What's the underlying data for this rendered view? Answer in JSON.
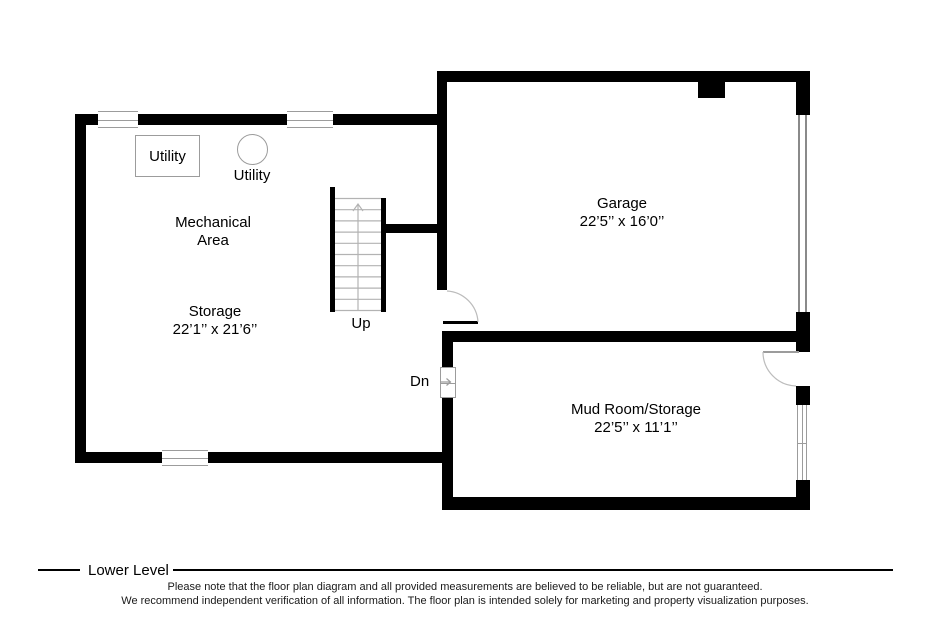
{
  "floor_label": "Lower Level",
  "rooms": {
    "storage": {
      "area_line1": "Mechanical",
      "area_line2": "Area",
      "name": "Storage",
      "dims": "22’1’’ x 21’6’’"
    },
    "garage": {
      "name": "Garage",
      "dims": "22’5’’ x 16’0’’"
    },
    "mudroom": {
      "name": "Mud Room/Storage",
      "dims": "22’5’’ x 11’1’’"
    }
  },
  "fixtures": {
    "utility_box_label": "Utility",
    "utility_circle_label": "Utility"
  },
  "stairs": {
    "up_label": "Up",
    "down_label": "Dn"
  },
  "disclaimer": {
    "line1": "Please note that the floor plan diagram and all provided measurements are believed to be reliable, but are not guaranteed.",
    "line2": "We recommend independent verification of all information. The floor plan is intended solely for marketing and property visualization purposes."
  },
  "colors": {
    "wall": "#000000",
    "fixture_line": "#9c9c9c",
    "stair_line": "#b3b3b3",
    "text": "#000000"
  }
}
